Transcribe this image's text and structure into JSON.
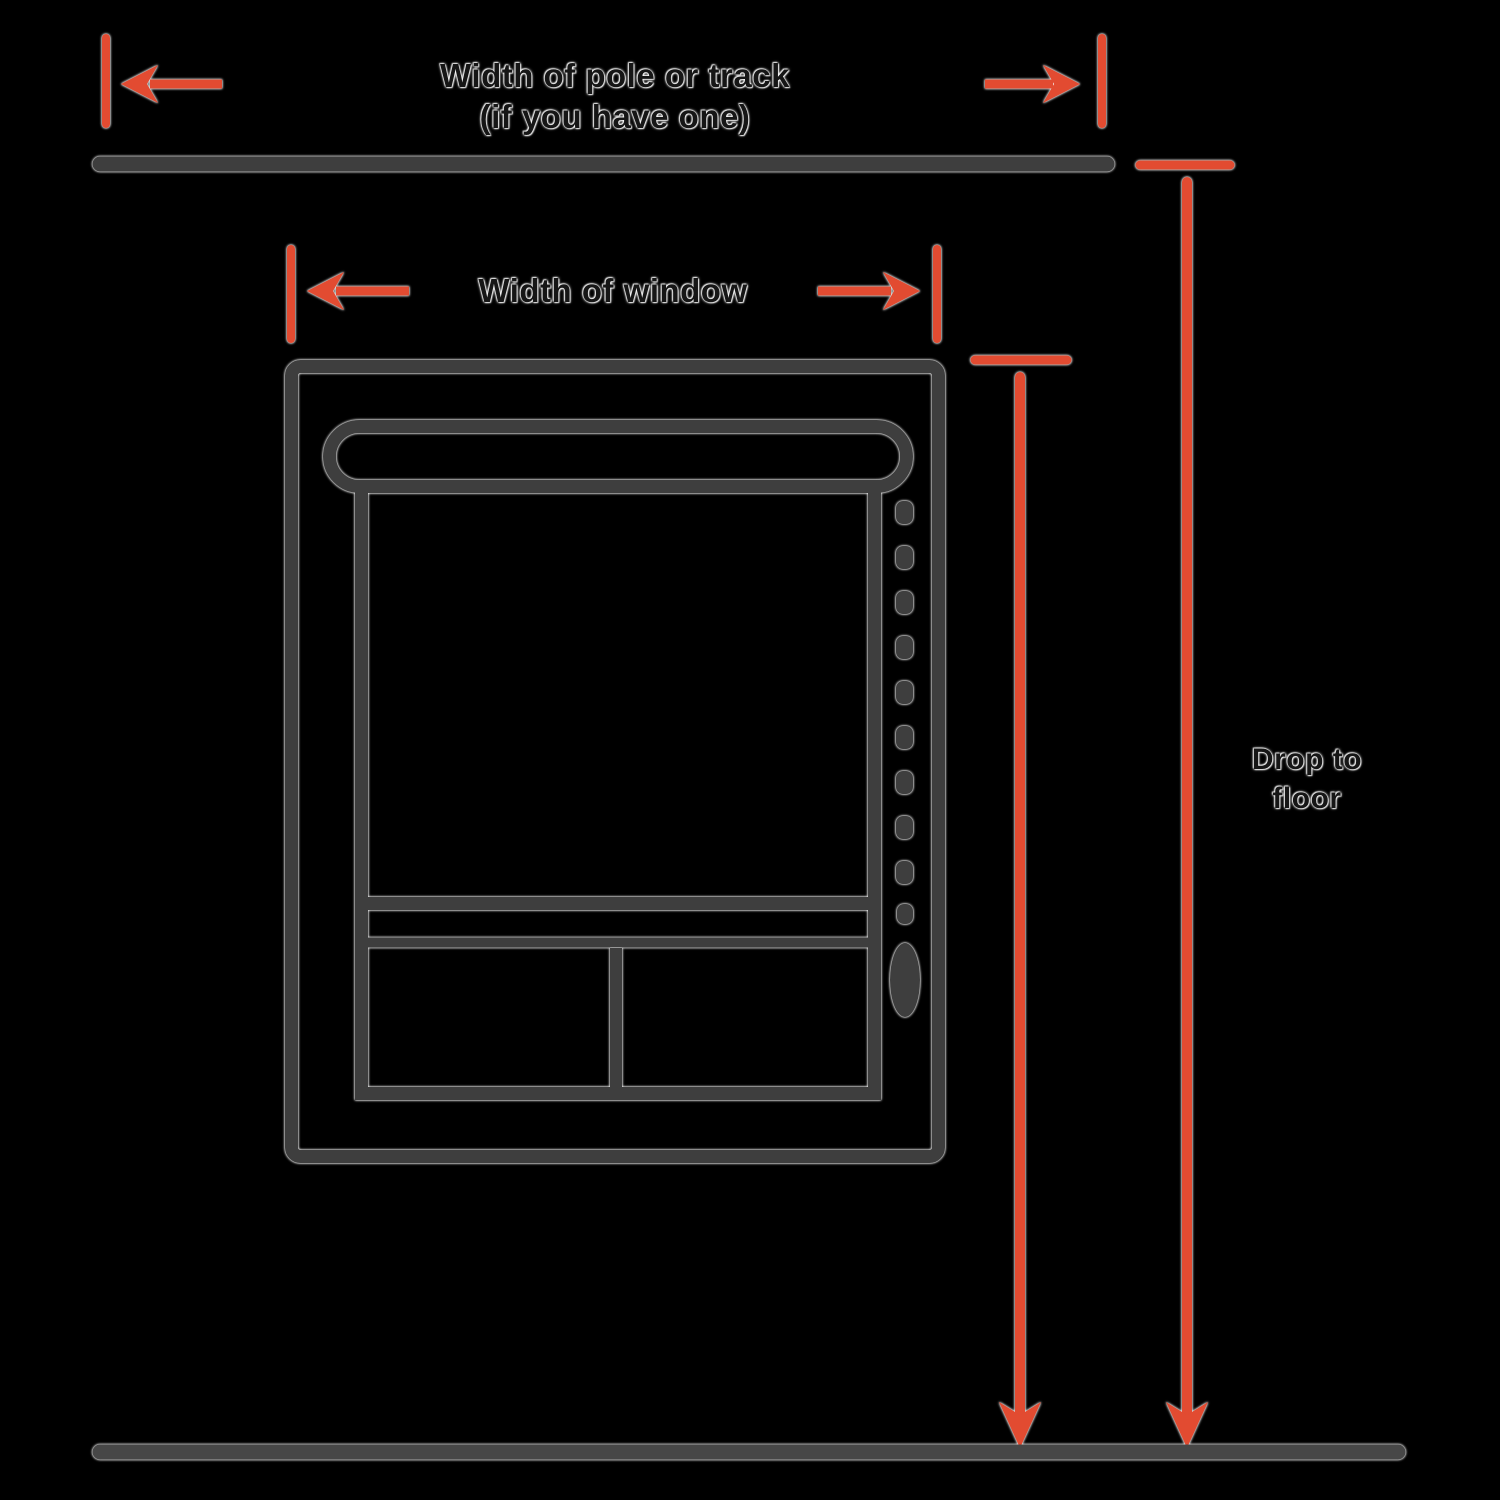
{
  "page": {
    "description": "Window measuring guide diagram for blinds and curtains"
  },
  "colors": {
    "background": "#000000",
    "ink": "#3e3e3e",
    "floor_line": "#474747",
    "arrow": "#e24b31",
    "label_text": "#161616",
    "halo": "#ffffff"
  },
  "labels": {
    "pole_width": {
      "line1": "Width of pole or track",
      "line2": "(if you have one)"
    },
    "window_width": "Width of window",
    "drop": {
      "line1": "Drop to",
      "line2": "floor"
    }
  }
}
